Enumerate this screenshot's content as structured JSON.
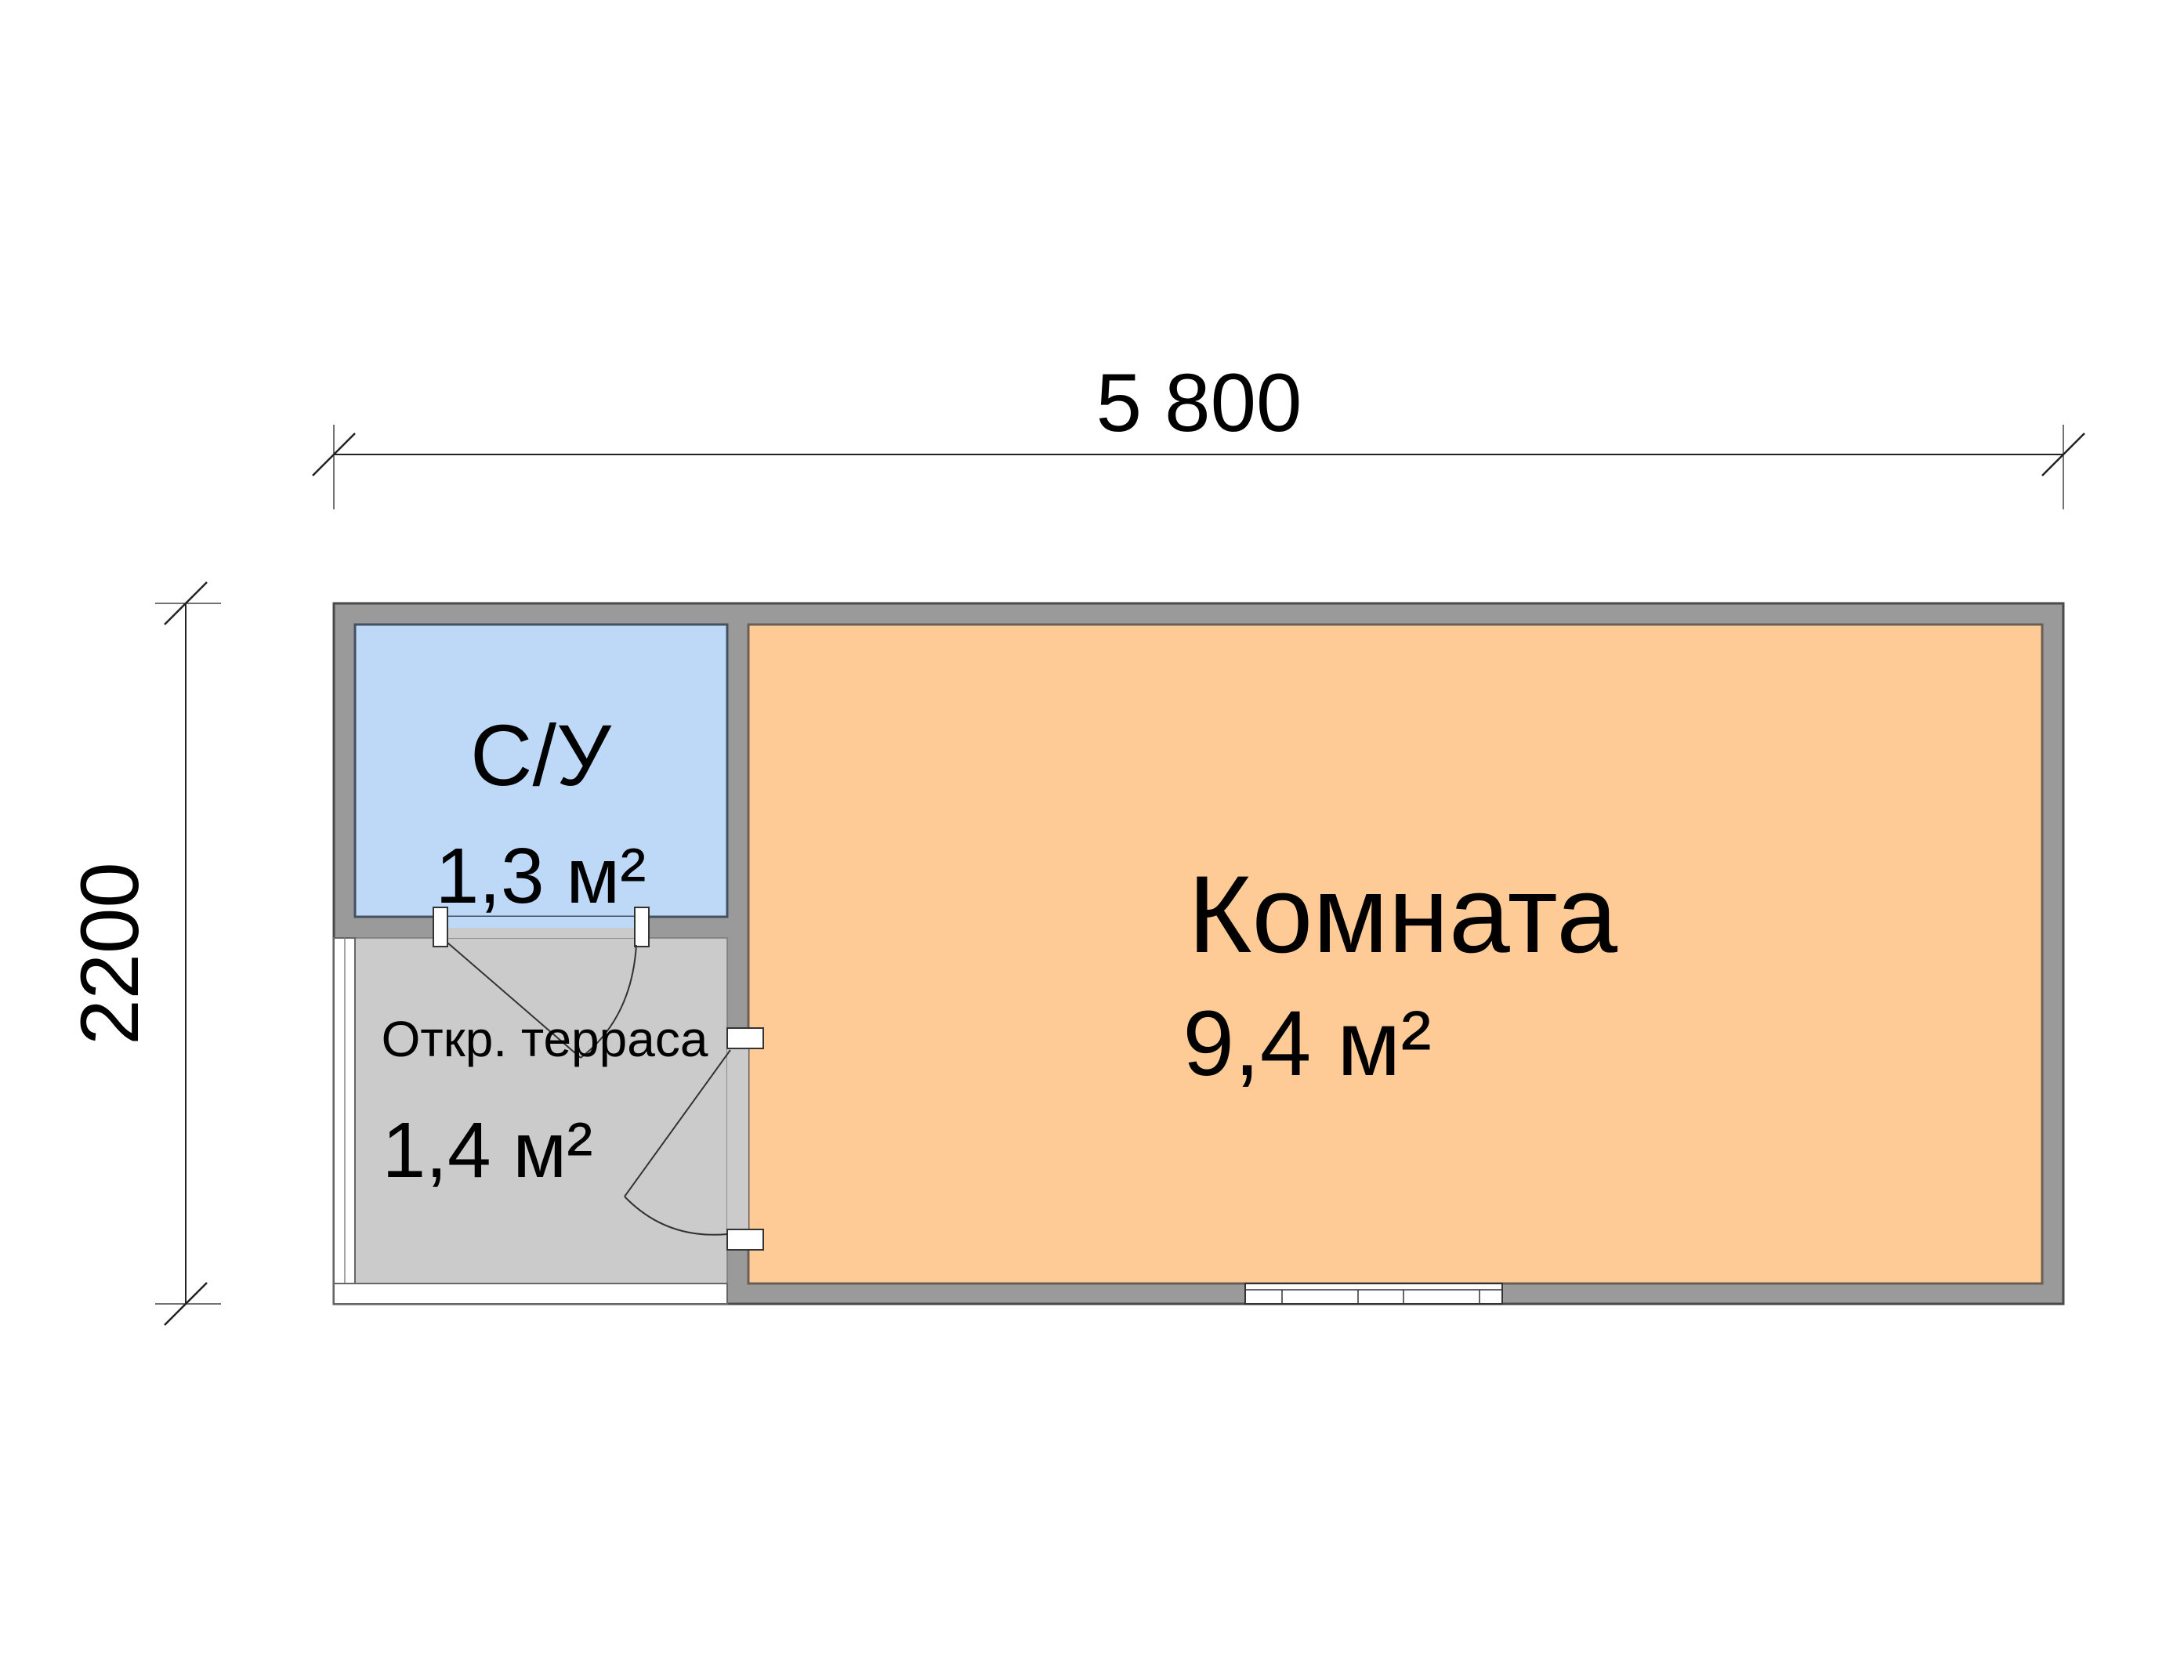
{
  "dimensions": {
    "top_label": "5 800",
    "left_label": "2200"
  },
  "rooms": {
    "bathroom": {
      "name": "С/У",
      "area": "1,3 м²"
    },
    "terrace": {
      "name": "Откр. терраса",
      "area": "1,4 м²"
    },
    "main": {
      "name": "Комната",
      "area": "9,4 м²"
    }
  },
  "colors": {
    "bathroom_fill": "#BED9F8",
    "bathroom_outline": "#44515F",
    "main_room_fill": "#FECB97",
    "main_room_outline": "#6A5F55",
    "terrace_fill": "#CBCBCB",
    "wall_fill": "#9A9A9A",
    "wall_outline": "#4A4A4A",
    "line_color": "#333333"
  }
}
